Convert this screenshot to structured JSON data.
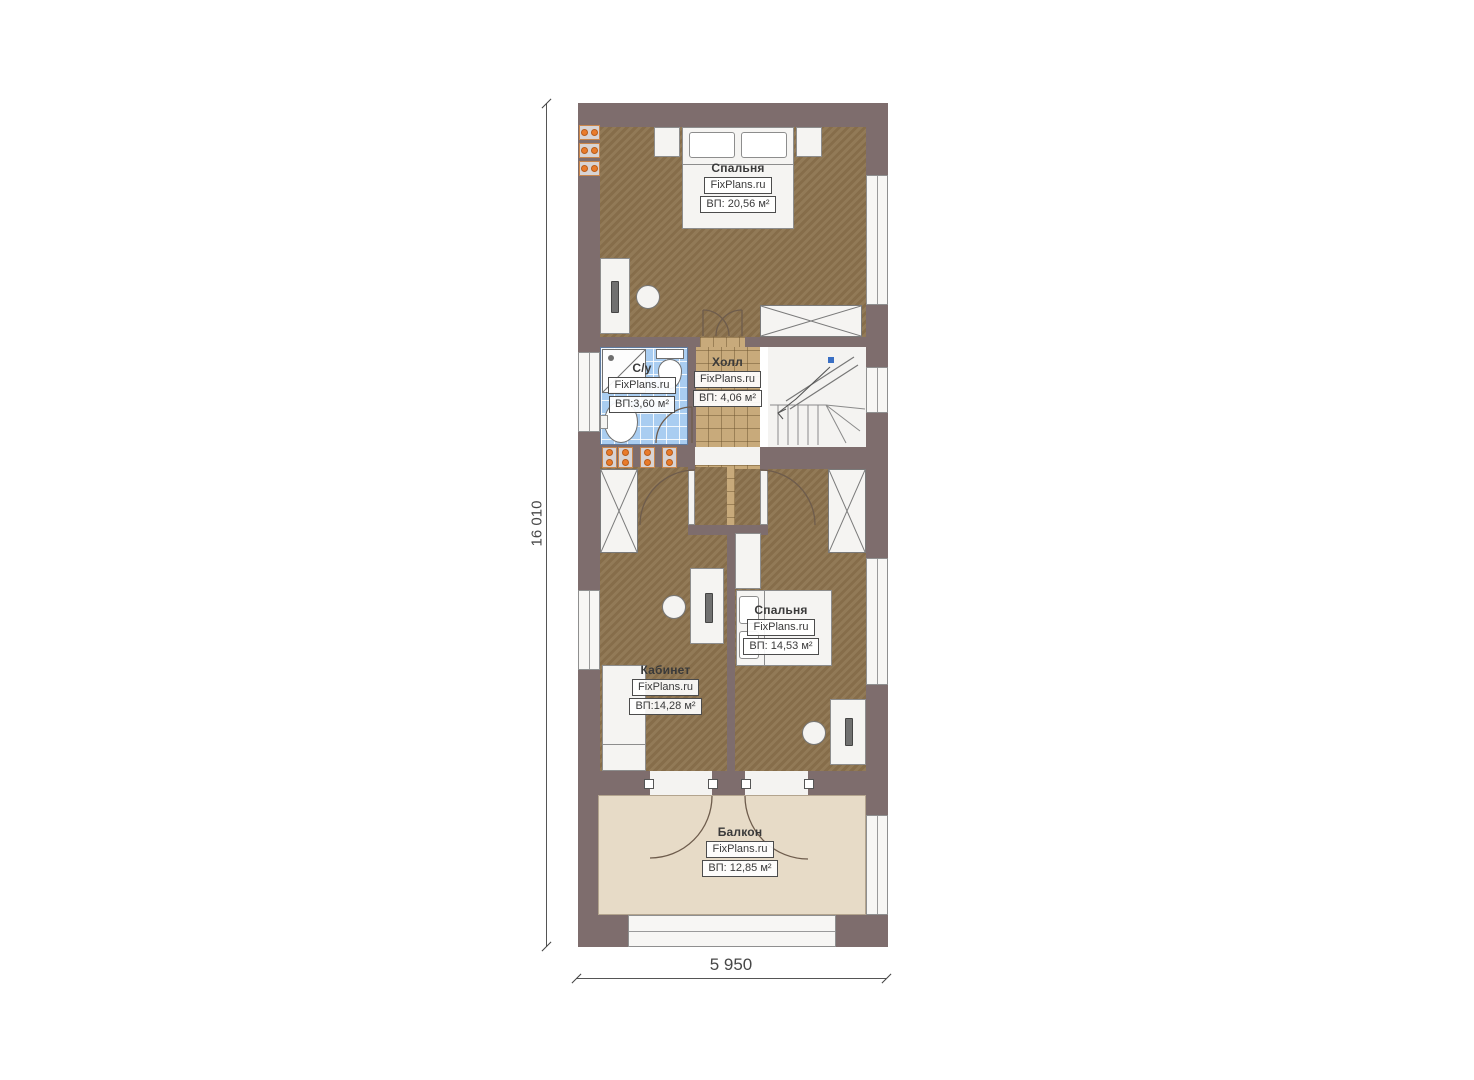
{
  "plan": {
    "title": "floor-plan",
    "rooms": [
      {
        "key": "bedroom-top",
        "name": "Спальня",
        "brand": "FixPlans.ru",
        "area": "ВП: 20,56 м²"
      },
      {
        "key": "bathroom",
        "name": "С/у",
        "brand": "FixPlans.ru",
        "area": "ВП:3,60 м²"
      },
      {
        "key": "hall",
        "name": "Холл",
        "brand": "FixPlans.ru",
        "area": "ВП: 4,06 м²"
      },
      {
        "key": "office",
        "name": "Кабинет",
        "brand": "FixPlans.ru",
        "area": "ВП:14,28 м²"
      },
      {
        "key": "bedroom-2",
        "name": "Спальня",
        "brand": "FixPlans.ru",
        "area": "ВП: 14,53 м²"
      },
      {
        "key": "balcony",
        "name": "Балкон",
        "brand": "FixPlans.ru",
        "area": "ВП: 12,85 м²"
      }
    ],
    "dimensions": {
      "height_label": "16 010",
      "width_label": "5 950"
    },
    "colors": {
      "wall": "#7e6d6d",
      "wood_floor": "#8c734e",
      "hall_tile": "#c8aa7b",
      "bath_tile": "#a9cdf1",
      "balcony_floor": "#e7dbc7",
      "radiator": "#e97b2b",
      "stair_marker_blue": "#3a6fc4"
    }
  }
}
